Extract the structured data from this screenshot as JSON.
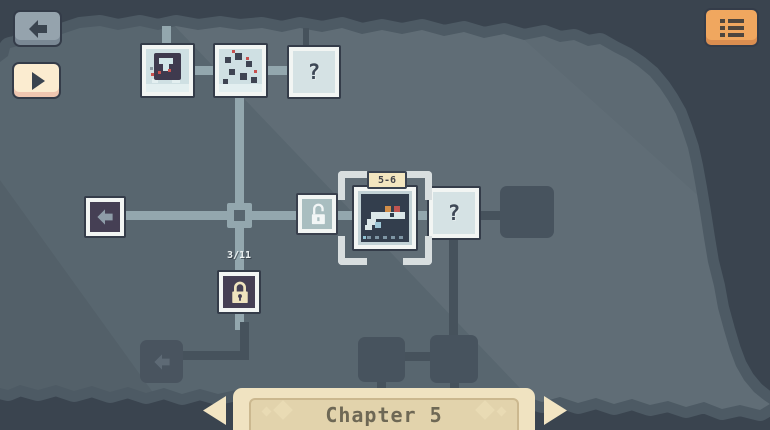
{
  "screen": "chapter-map",
  "toolbar": {
    "back_button_icon": "arrow-left",
    "play_button_icon": "play",
    "menu_button_icon": "list-menu"
  },
  "map": {
    "unknown_marker": "?",
    "selected_level": {
      "label": "5-6",
      "state": "selected"
    },
    "gate": {
      "progress": "3/11",
      "icon": "padlock-closed"
    },
    "unlock_marker_icon": "padlock-open",
    "nodes": [
      {
        "id": "level-top-1",
        "type": "level-thumbnail",
        "state": "revealed"
      },
      {
        "id": "level-top-2",
        "type": "level-thumbnail",
        "state": "revealed"
      },
      {
        "id": "level-top-3",
        "type": "unknown-level",
        "state": "revealed"
      },
      {
        "id": "exit-left",
        "type": "exit-arrow",
        "state": "revealed"
      },
      {
        "id": "path-junction",
        "type": "junction",
        "state": "revealed"
      },
      {
        "id": "unlock-marker",
        "type": "padlock-open-marker",
        "state": "revealed"
      },
      {
        "id": "level-5-6",
        "type": "level-thumbnail",
        "state": "selected",
        "label": "5-6"
      },
      {
        "id": "level-right",
        "type": "unknown-level",
        "state": "revealed"
      },
      {
        "id": "hidden-right",
        "type": "hidden-node",
        "state": "locked"
      },
      {
        "id": "gate-lock",
        "type": "gate",
        "progress": "3/11",
        "state": "locked"
      },
      {
        "id": "exit-bottom-left",
        "type": "exit-arrow",
        "state": "locked"
      },
      {
        "id": "hidden-bottom-1",
        "type": "hidden-node",
        "state": "locked"
      },
      {
        "id": "hidden-bottom-2",
        "type": "hidden-node",
        "state": "locked"
      }
    ]
  },
  "footer": {
    "chapter_label": "Chapter 5",
    "prev_icon": "arrow-left",
    "next_icon": "arrow-right"
  },
  "colors": {
    "background": "#3A444F",
    "map_surface": "#58666F",
    "map_edge_band": "#4D5A64",
    "path_light": "#93A7AE",
    "path_dark": "#46525C",
    "tile_frame": "#F2F5F3",
    "tile_outline": "#343C49",
    "tile_bg_light": "#D5E2E4",
    "tile_bg_purple": "#453F54",
    "hidden_node": "#47535E",
    "accent_orange": "#F0A75F",
    "banner_cream": "#F0E3C1",
    "banner_inner": "#E2D3AC",
    "label_tab": "#F3E6C0",
    "red_block": "#C7504E",
    "orange_block": "#D28E49"
  }
}
